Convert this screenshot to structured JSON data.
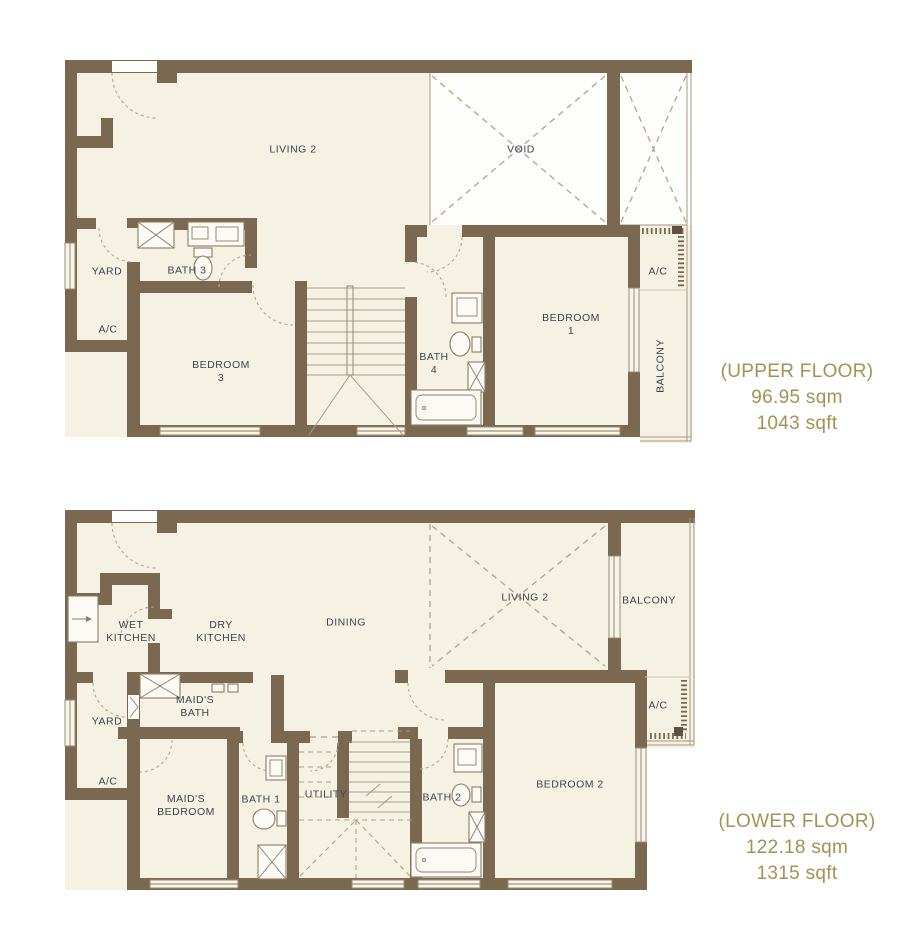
{
  "colors": {
    "wall": "#7a6851",
    "floor": "#f5f1e3",
    "accent_text": "#a29254",
    "label_text": "#3e444c",
    "dashed_line": "#b9a88f"
  },
  "upper_floor": {
    "labels": {
      "living": "LIVING 2",
      "void": "VOID",
      "yard": "YARD",
      "bath3": "BATH 3",
      "ac_left": "A/C",
      "bedroom3": "BEDROOM\n3",
      "bath4": "BATH\n4",
      "bedroom1": "BEDROOM\n1",
      "ac_right": "A/C",
      "balcony": "BALCONY"
    },
    "title": "(UPPER FLOOR)",
    "area_sqm": "96.95 sqm",
    "area_sqft": "1043 sqft"
  },
  "lower_floor": {
    "labels": {
      "wet_kitchen": "WET\nKITCHEN",
      "dry_kitchen": "DRY\nKITCHEN",
      "dining": "DINING",
      "living": "LIVING 2",
      "balcony": "BALCONY",
      "yard": "YARD",
      "maids_bath": "MAID'S\nBATH",
      "ac_left": "A/C",
      "maids_bedroom": "MAID'S\nBEDROOM",
      "bath1": "BATH 1",
      "utility": "UTILITY",
      "bath2": "BATH 2",
      "bedroom2": "BEDROOM 2",
      "ac_right": "A/C"
    },
    "title": "(LOWER FLOOR)",
    "area_sqm": "122.18 sqm",
    "area_sqft": "1315 sqft"
  }
}
